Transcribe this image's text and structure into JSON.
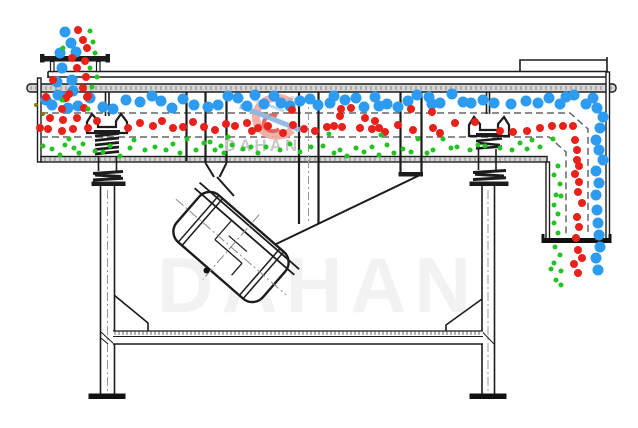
{
  "watermark": {
    "text": "DAHAN",
    "reg": "®",
    "big_text": "DAHAN"
  },
  "colors": {
    "blue": "#2d9bf0",
    "red": "#e9211a",
    "green": "#22c422",
    "olive": "#8a7a00"
  },
  "sizes": {
    "blue": 11,
    "red": 8,
    "green": 5,
    "olive": 4
  },
  "particles": {
    "blue": [
      [
        65,
        32
      ],
      [
        71,
        43
      ],
      [
        60,
        53
      ],
      [
        76,
        52
      ],
      [
        62,
        68
      ],
      [
        72,
        80
      ],
      [
        57,
        82
      ],
      [
        73,
        91
      ],
      [
        64,
        97
      ],
      [
        46,
        100
      ],
      [
        52,
        105
      ],
      [
        58,
        95
      ],
      [
        68,
        108
      ],
      [
        78,
        106
      ],
      [
        90,
        98
      ],
      [
        103,
        107
      ],
      [
        113,
        109
      ],
      [
        126,
        100
      ],
      [
        140,
        102
      ],
      [
        152,
        96
      ],
      [
        161,
        101
      ],
      [
        172,
        108
      ],
      [
        183,
        99
      ],
      [
        194,
        105
      ],
      [
        208,
        107
      ],
      [
        218,
        105
      ],
      [
        228,
        96
      ],
      [
        238,
        98
      ],
      [
        247,
        106
      ],
      [
        255,
        95
      ],
      [
        264,
        104
      ],
      [
        274,
        96
      ],
      [
        281,
        103
      ],
      [
        290,
        106
      ],
      [
        300,
        101
      ],
      [
        310,
        99
      ],
      [
        318,
        105
      ],
      [
        330,
        103
      ],
      [
        334,
        96
      ],
      [
        345,
        100
      ],
      [
        356,
        98
      ],
      [
        364,
        107
      ],
      [
        375,
        97
      ],
      [
        379,
        106
      ],
      [
        387,
        104
      ],
      [
        398,
        107
      ],
      [
        408,
        101
      ],
      [
        417,
        95
      ],
      [
        429,
        97
      ],
      [
        432,
        104
      ],
      [
        440,
        103
      ],
      [
        452,
        94
      ],
      [
        463,
        102
      ],
      [
        471,
        103
      ],
      [
        483,
        100
      ],
      [
        494,
        103
      ],
      [
        511,
        104
      ],
      [
        526,
        101
      ],
      [
        538,
        103
      ],
      [
        549,
        98
      ],
      [
        560,
        104
      ],
      [
        566,
        97
      ],
      [
        574,
        95
      ],
      [
        586,
        104
      ],
      [
        593,
        98
      ],
      [
        597,
        108
      ],
      [
        603,
        117
      ],
      [
        600,
        128
      ],
      [
        596,
        140
      ],
      [
        599,
        150
      ],
      [
        603,
        160
      ],
      [
        596,
        171
      ],
      [
        599,
        183
      ],
      [
        596,
        195
      ],
      [
        597,
        210
      ],
      [
        598,
        223
      ],
      [
        599,
        235
      ],
      [
        600,
        247
      ],
      [
        596,
        258
      ],
      [
        598,
        270
      ]
    ],
    "red": [
      [
        78,
        30
      ],
      [
        83,
        40
      ],
      [
        87,
        48
      ],
      [
        72,
        58
      ],
      [
        85,
        61
      ],
      [
        77,
        68
      ],
      [
        86,
        77
      ],
      [
        53,
        80
      ],
      [
        83,
        88
      ],
      [
        88,
        96
      ],
      [
        46,
        97
      ],
      [
        66,
        98
      ],
      [
        69,
        94
      ],
      [
        87,
        97
      ],
      [
        62,
        109
      ],
      [
        84,
        108
      ],
      [
        292,
        110
      ],
      [
        341,
        109
      ],
      [
        351,
        108
      ],
      [
        411,
        109
      ],
      [
        432,
        112
      ],
      [
        340,
        116
      ],
      [
        365,
        118
      ],
      [
        375,
        121
      ],
      [
        40,
        128
      ],
      [
        50,
        118
      ],
      [
        63,
        120
      ],
      [
        77,
        118
      ],
      [
        48,
        129
      ],
      [
        62,
        131
      ],
      [
        73,
        129
      ],
      [
        88,
        128
      ],
      [
        97,
        121
      ],
      [
        128,
        128
      ],
      [
        140,
        123
      ],
      [
        153,
        126
      ],
      [
        162,
        121
      ],
      [
        173,
        128
      ],
      [
        183,
        127
      ],
      [
        193,
        122
      ],
      [
        204,
        127
      ],
      [
        215,
        130
      ],
      [
        226,
        124
      ],
      [
        235,
        126
      ],
      [
        247,
        123
      ],
      [
        252,
        131
      ],
      [
        258,
        128
      ],
      [
        268,
        126
      ],
      [
        283,
        133
      ],
      [
        293,
        125
      ],
      [
        304,
        129
      ],
      [
        315,
        131
      ],
      [
        327,
        127
      ],
      [
        334,
        126
      ],
      [
        342,
        127
      ],
      [
        360,
        128
      ],
      [
        372,
        129
      ],
      [
        379,
        128
      ],
      [
        385,
        132
      ],
      [
        398,
        125
      ],
      [
        413,
        130
      ],
      [
        433,
        128
      ],
      [
        440,
        133
      ],
      [
        455,
        123
      ],
      [
        475,
        122
      ],
      [
        500,
        131
      ],
      [
        513,
        132
      ],
      [
        527,
        131
      ],
      [
        540,
        128
      ],
      [
        552,
        126
      ],
      [
        563,
        126
      ],
      [
        573,
        126
      ],
      [
        575,
        140
      ],
      [
        577,
        150
      ],
      [
        577,
        160
      ],
      [
        579,
        166
      ],
      [
        575,
        174
      ],
      [
        579,
        182
      ],
      [
        578,
        192
      ],
      [
        582,
        203
      ],
      [
        577,
        217
      ],
      [
        579,
        227
      ],
      [
        576,
        238
      ],
      [
        578,
        250
      ],
      [
        582,
        258
      ],
      [
        574,
        264
      ],
      [
        578,
        273
      ]
    ],
    "green": [
      [
        90,
        31
      ],
      [
        93,
        42
      ],
      [
        63,
        48
      ],
      [
        95,
        53
      ],
      [
        90,
        68
      ],
      [
        97,
        77
      ],
      [
        92,
        87
      ],
      [
        62,
        100
      ],
      [
        88,
        109
      ],
      [
        134,
        140
      ],
      [
        187,
        139
      ],
      [
        221,
        146
      ],
      [
        43,
        146
      ],
      [
        52,
        149
      ],
      [
        60,
        155
      ],
      [
        65,
        145
      ],
      [
        69,
        139
      ],
      [
        74,
        148
      ],
      [
        79,
        153
      ],
      [
        83,
        144
      ],
      [
        95,
        151
      ],
      [
        103,
        152
      ],
      [
        110,
        146
      ],
      [
        120,
        156
      ],
      [
        130,
        148
      ],
      [
        145,
        150
      ],
      [
        155,
        147
      ],
      [
        166,
        150
      ],
      [
        173,
        144
      ],
      [
        180,
        153
      ],
      [
        196,
        150
      ],
      [
        204,
        143
      ],
      [
        210,
        142
      ],
      [
        215,
        150
      ],
      [
        224,
        153
      ],
      [
        228,
        137
      ],
      [
        232,
        145
      ],
      [
        243,
        149
      ],
      [
        251,
        147
      ],
      [
        258,
        153
      ],
      [
        266,
        147
      ],
      [
        280,
        150
      ],
      [
        290,
        144
      ],
      [
        300,
        152
      ],
      [
        311,
        147
      ],
      [
        323,
        146
      ],
      [
        329,
        134
      ],
      [
        334,
        153
      ],
      [
        340,
        150
      ],
      [
        347,
        156
      ],
      [
        356,
        148
      ],
      [
        364,
        152
      ],
      [
        372,
        147
      ],
      [
        379,
        155
      ],
      [
        381,
        135
      ],
      [
        387,
        145
      ],
      [
        394,
        153
      ],
      [
        403,
        149
      ],
      [
        411,
        152
      ],
      [
        418,
        139
      ],
      [
        427,
        153
      ],
      [
        433,
        150
      ],
      [
        443,
        139
      ],
      [
        451,
        148
      ],
      [
        457,
        147
      ],
      [
        470,
        150
      ],
      [
        478,
        145
      ],
      [
        485,
        146
      ],
      [
        500,
        148
      ],
      [
        512,
        150
      ],
      [
        520,
        143
      ],
      [
        527,
        149
      ],
      [
        532,
        140
      ],
      [
        540,
        147
      ],
      [
        553,
        139
      ],
      [
        561,
        196
      ],
      [
        558,
        166
      ],
      [
        554,
        175
      ],
      [
        560,
        184
      ],
      [
        556,
        195
      ],
      [
        554,
        205
      ],
      [
        558,
        214
      ],
      [
        554,
        223
      ],
      [
        558,
        233
      ],
      [
        555,
        247
      ],
      [
        560,
        255
      ],
      [
        554,
        263
      ],
      [
        551,
        269
      ],
      [
        561,
        271
      ],
      [
        556,
        280
      ],
      [
        561,
        285
      ]
    ],
    "olive": [
      [
        36,
        105
      ],
      [
        43,
        114
      ]
    ]
  }
}
